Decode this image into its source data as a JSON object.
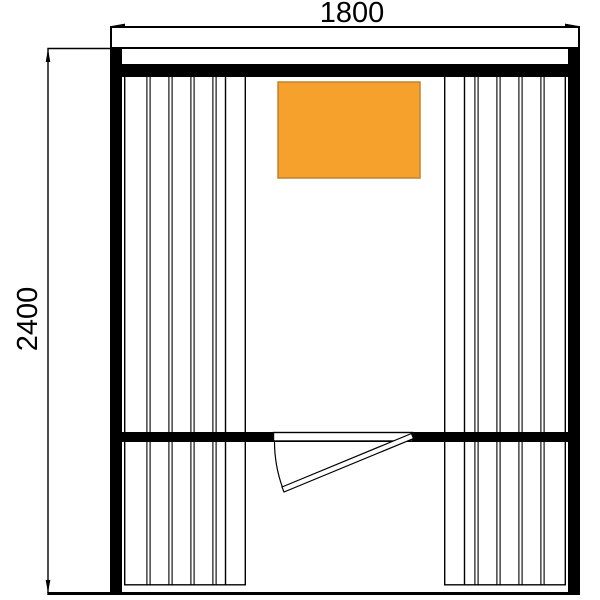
{
  "dimensions": {
    "width_label": "1800",
    "height_label": "2400"
  },
  "colors": {
    "line": "#000000",
    "background": "#ffffff",
    "heater_fill": "#f6a12c",
    "heater_border": "#c08330"
  }
}
